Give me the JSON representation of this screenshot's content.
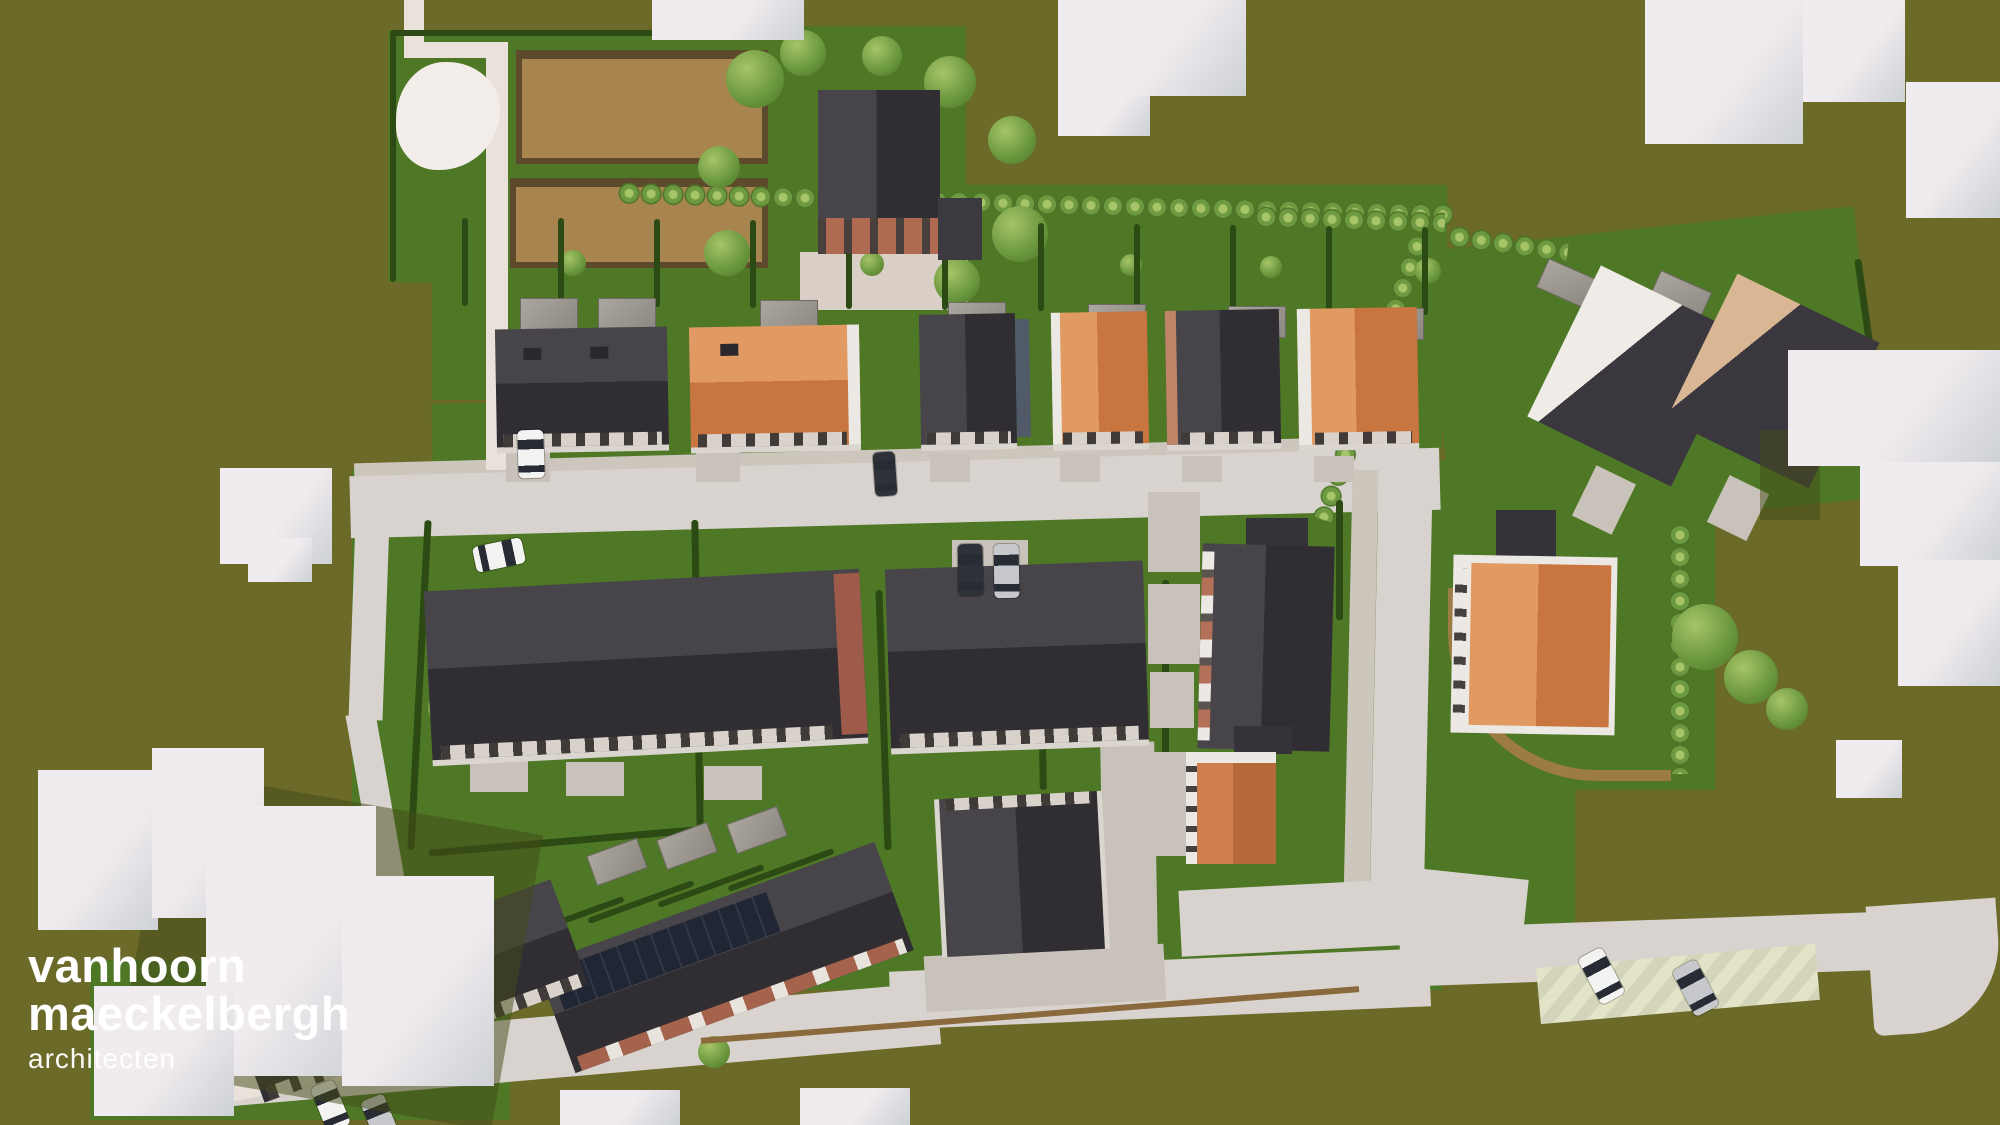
{
  "logo": {
    "line1": "vanhoorn",
    "line2": "maeckelbergh",
    "line3": "architecten"
  },
  "palette": {
    "olive": "#6b6a28",
    "oliveShadow": "#434a18",
    "grass": "#4e7826",
    "grassLight": "#5d8c33",
    "hedge": "#2c4a13",
    "treeA": "#a7c468",
    "treeB": "#6d9a40",
    "treeC": "#4c7427",
    "road": "#d8d3ce",
    "roadWarm": "#eae2da",
    "pave": "#c9c2ba",
    "sidewalk": "#cdc6bd",
    "roofDarkLight": "#47454a",
    "roofDarkDeep": "#312e33",
    "roofOrangeLight": "#e09a62",
    "roofOrangeDeep": "#c8753f",
    "wallWhite": "#ece9e4",
    "brick": "#a5624d",
    "brickLight": "#c08468",
    "massing": "#f0ebee",
    "massingSide": "#cdd1d6",
    "dirt": "#a8854f",
    "dirtEdge": "#5d4a2c",
    "dirtPath": "#9c7b44",
    "fence": "#8a6a3c",
    "carWhite": "#f3f3f2",
    "carSilver": "#c7c8cc",
    "carDark": "#2f3138",
    "shed": "#a19c94",
    "logoText": "#ffffff"
  }
}
